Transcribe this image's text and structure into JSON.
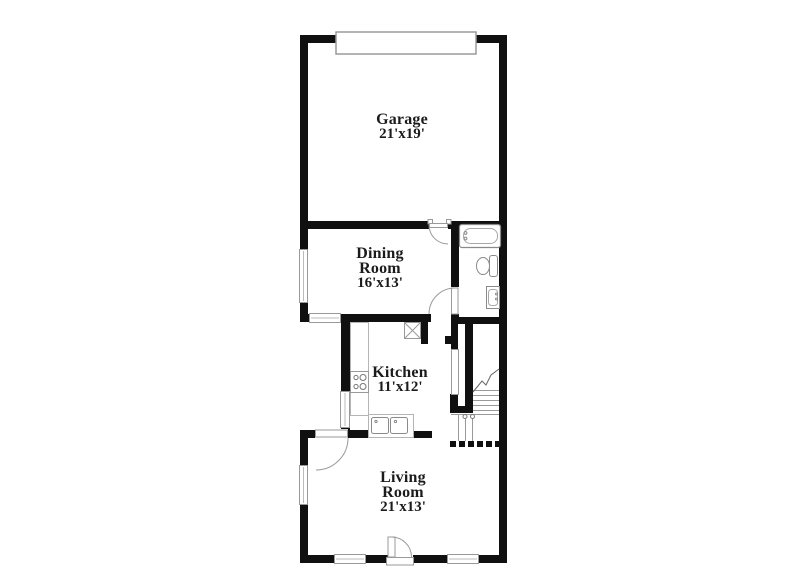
{
  "floor_plan": {
    "rooms": [
      {
        "id": "garage",
        "name": "Garage",
        "dimensions": "21'x19'"
      },
      {
        "id": "dining-room",
        "name": "Dining Room",
        "dimensions": "16'x13'"
      },
      {
        "id": "kitchen",
        "name": "Kitchen",
        "dimensions": "11'x12'"
      },
      {
        "id": "living-room",
        "name": "Living Room",
        "dimensions": "21'x13'"
      }
    ],
    "fixtures": [
      "garage-door",
      "bathtub",
      "toilet",
      "bathroom-sink",
      "stove",
      "kitchen-sink",
      "refrigerator",
      "stairs",
      "window",
      "door"
    ],
    "colors": {
      "background": "#ffffff",
      "wall": "#101010",
      "window_border": "#999999",
      "fixture_outline": "#8a8a8a",
      "text": "#1b1b1b"
    }
  }
}
